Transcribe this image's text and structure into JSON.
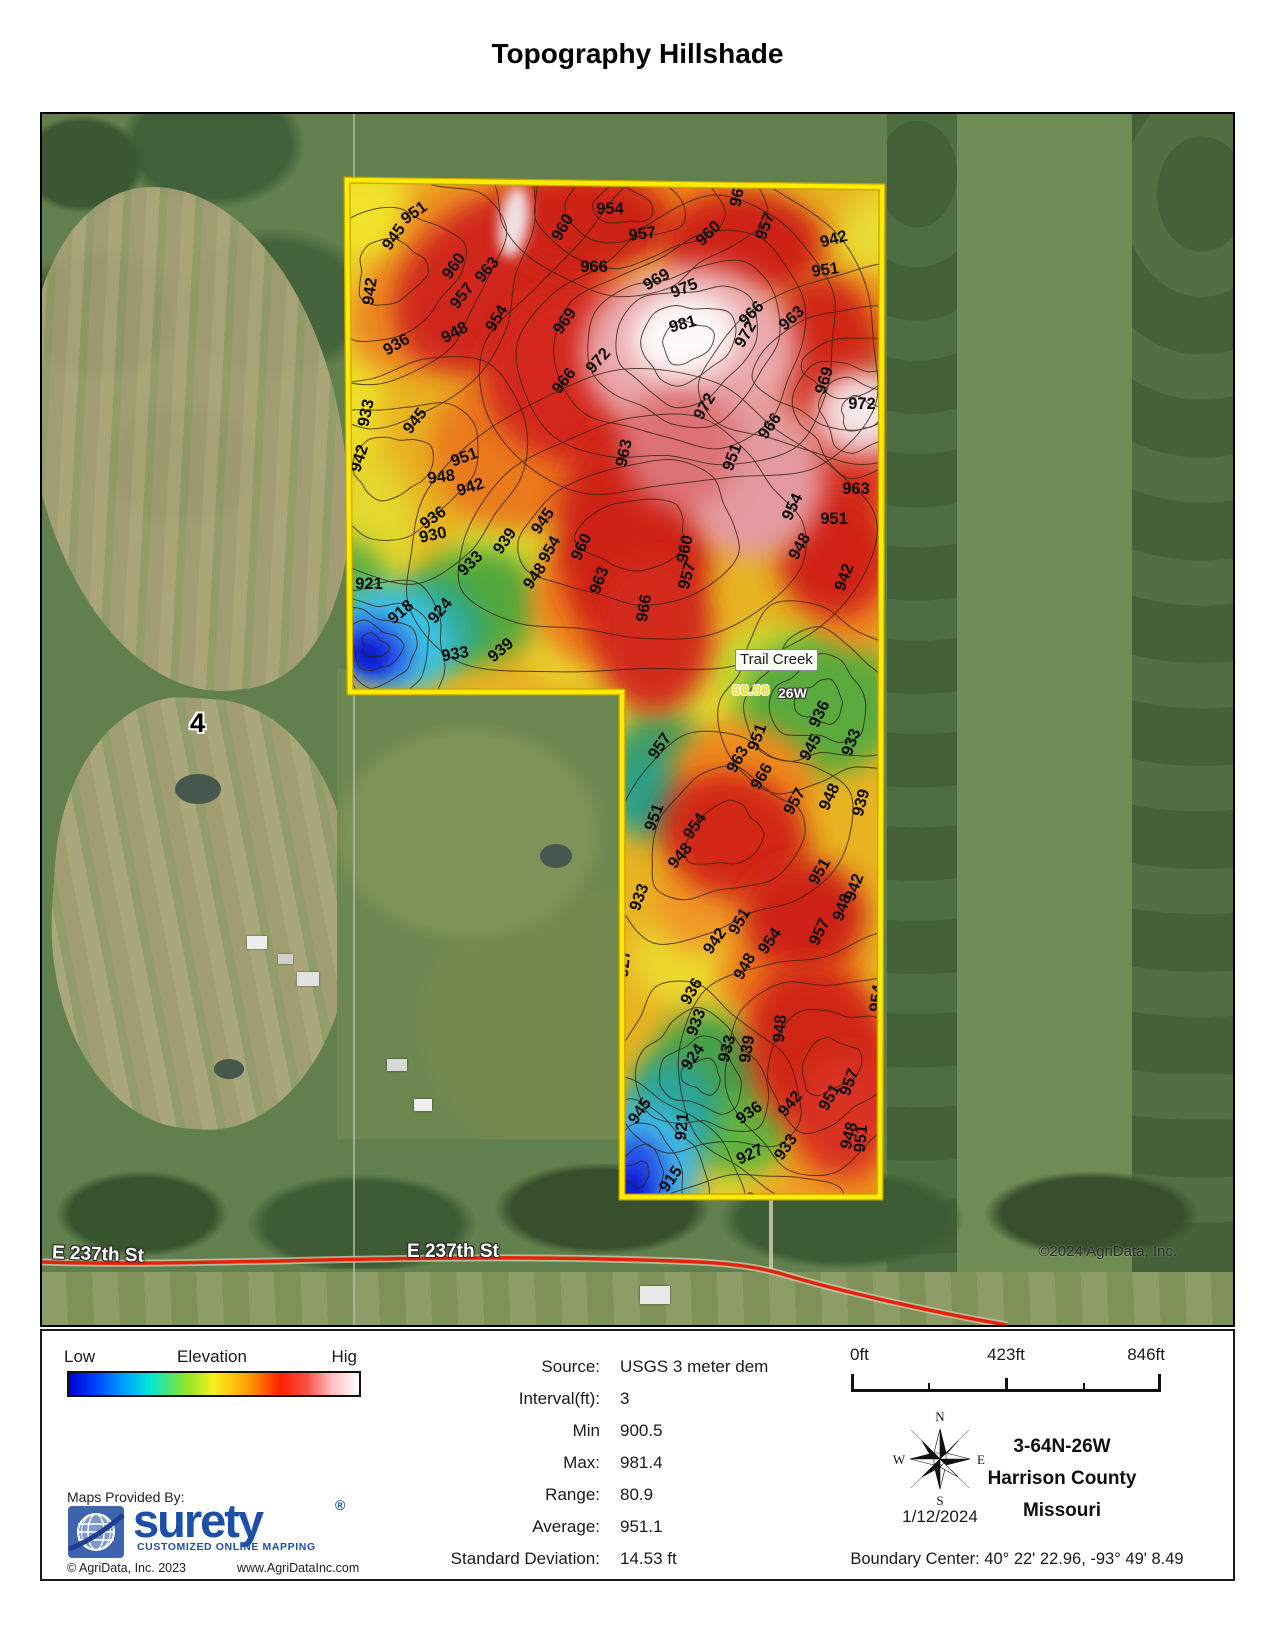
{
  "title": "Topography Hillshade",
  "map": {
    "labels": {
      "trail_creek": "Trail Creek",
      "road_number": "60.00",
      "road_suffix": "26W",
      "street_left": "E 237th St",
      "street_center": "E 237th St",
      "section_number": "4",
      "copyright": "©2024 AgriData, Inc."
    },
    "contour_labels": [
      {
        "t": "951",
        "x": 375,
        "y": 103,
        "r": -35
      },
      {
        "t": "945",
        "x": 356,
        "y": 126,
        "r": -55
      },
      {
        "t": "954",
        "x": 568,
        "y": 100,
        "r": 0
      },
      {
        "t": "957",
        "x": 601,
        "y": 125,
        "r": -8
      },
      {
        "t": "960",
        "x": 525,
        "y": 116,
        "r": -60
      },
      {
        "t": "963",
        "x": 701,
        "y": 80,
        "r": -78
      },
      {
        "t": "957",
        "x": 728,
        "y": 114,
        "r": -70
      },
      {
        "t": "960",
        "x": 670,
        "y": 123,
        "r": -45
      },
      {
        "t": "942",
        "x": 793,
        "y": 130,
        "r": -15
      },
      {
        "t": "951",
        "x": 784,
        "y": 161,
        "r": -8
      },
      {
        "t": "960",
        "x": 416,
        "y": 155,
        "r": -55
      },
      {
        "t": "963",
        "x": 449,
        "y": 159,
        "r": -50
      },
      {
        "t": "966",
        "x": 552,
        "y": 158,
        "r": 0
      },
      {
        "t": "957",
        "x": 424,
        "y": 185,
        "r": -52
      },
      {
        "t": "954",
        "x": 459,
        "y": 207,
        "r": -58
      },
      {
        "t": "969",
        "x": 617,
        "y": 170,
        "r": -30
      },
      {
        "t": "975",
        "x": 644,
        "y": 179,
        "r": -22
      },
      {
        "t": "966",
        "x": 713,
        "y": 203,
        "r": -45
      },
      {
        "t": "963",
        "x": 753,
        "y": 208,
        "r": -42
      },
      {
        "t": "972",
        "x": 708,
        "y": 223,
        "r": -60
      },
      {
        "t": "942",
        "x": 333,
        "y": 178,
        "r": -82
      },
      {
        "t": "936",
        "x": 357,
        "y": 235,
        "r": -30
      },
      {
        "t": "948",
        "x": 415,
        "y": 223,
        "r": -28
      },
      {
        "t": "981",
        "x": 642,
        "y": 215,
        "r": -15
      },
      {
        "t": "969",
        "x": 527,
        "y": 210,
        "r": -55
      },
      {
        "t": "972",
        "x": 560,
        "y": 250,
        "r": -48
      },
      {
        "t": "966",
        "x": 526,
        "y": 270,
        "r": -52
      },
      {
        "t": "969",
        "x": 787,
        "y": 268,
        "r": -72
      },
      {
        "t": "972",
        "x": 820,
        "y": 295,
        "r": 0
      },
      {
        "t": "933",
        "x": 329,
        "y": 300,
        "r": -78
      },
      {
        "t": "945",
        "x": 377,
        "y": 310,
        "r": -52
      },
      {
        "t": "942",
        "x": 322,
        "y": 346,
        "r": -72
      },
      {
        "t": "951",
        "x": 424,
        "y": 348,
        "r": -20
      },
      {
        "t": "948",
        "x": 400,
        "y": 368,
        "r": -8
      },
      {
        "t": "942",
        "x": 430,
        "y": 378,
        "r": -18
      },
      {
        "t": "963",
        "x": 587,
        "y": 340,
        "r": -78
      },
      {
        "t": "972",
        "x": 667,
        "y": 295,
        "r": -60
      },
      {
        "t": "966",
        "x": 732,
        "y": 315,
        "r": -55
      },
      {
        "t": "951",
        "x": 695,
        "y": 345,
        "r": -70
      },
      {
        "t": "963",
        "x": 814,
        "y": 380,
        "r": 0
      },
      {
        "t": "954",
        "x": 755,
        "y": 395,
        "r": -65
      },
      {
        "t": "951",
        "x": 792,
        "y": 410,
        "r": 0
      },
      {
        "t": "948",
        "x": 762,
        "y": 435,
        "r": -60
      },
      {
        "t": "936",
        "x": 394,
        "y": 408,
        "r": -35
      },
      {
        "t": "930",
        "x": 392,
        "y": 426,
        "r": -12
      },
      {
        "t": "939",
        "x": 467,
        "y": 430,
        "r": -55
      },
      {
        "t": "933",
        "x": 432,
        "y": 453,
        "r": -45
      },
      {
        "t": "945",
        "x": 505,
        "y": 410,
        "r": -55
      },
      {
        "t": "954",
        "x": 512,
        "y": 438,
        "r": -60
      },
      {
        "t": "960",
        "x": 544,
        "y": 435,
        "r": -65
      },
      {
        "t": "948",
        "x": 497,
        "y": 465,
        "r": -55
      },
      {
        "t": "963",
        "x": 562,
        "y": 468,
        "r": -70
      },
      {
        "t": "960",
        "x": 648,
        "y": 436,
        "r": -78
      },
      {
        "t": "957",
        "x": 650,
        "y": 463,
        "r": -75
      },
      {
        "t": "966",
        "x": 607,
        "y": 495,
        "r": -80
      },
      {
        "t": "942",
        "x": 807,
        "y": 465,
        "r": -70
      },
      {
        "t": "921",
        "x": 327,
        "y": 475,
        "r": 0
      },
      {
        "t": "918",
        "x": 362,
        "y": 502,
        "r": -40
      },
      {
        "t": "924",
        "x": 402,
        "y": 500,
        "r": -50
      },
      {
        "t": "933",
        "x": 414,
        "y": 545,
        "r": -10
      },
      {
        "t": "939",
        "x": 462,
        "y": 540,
        "r": -40
      },
      {
        "t": "936",
        "x": 782,
        "y": 602,
        "r": -65
      },
      {
        "t": "933",
        "x": 814,
        "y": 630,
        "r": -70
      },
      {
        "t": "945",
        "x": 773,
        "y": 636,
        "r": -60
      },
      {
        "t": "951",
        "x": 720,
        "y": 625,
        "r": -70
      },
      {
        "t": "957",
        "x": 622,
        "y": 635,
        "r": -55
      },
      {
        "t": "963",
        "x": 700,
        "y": 648,
        "r": -60
      },
      {
        "t": "966",
        "x": 724,
        "y": 665,
        "r": -60
      },
      {
        "t": "939",
        "x": 824,
        "y": 690,
        "r": -75
      },
      {
        "t": "948",
        "x": 792,
        "y": 685,
        "r": -65
      },
      {
        "t": "957",
        "x": 757,
        "y": 690,
        "r": -60
      },
      {
        "t": "951",
        "x": 617,
        "y": 705,
        "r": -70
      },
      {
        "t": "954",
        "x": 657,
        "y": 715,
        "r": -55
      },
      {
        "t": "948",
        "x": 642,
        "y": 745,
        "r": -50
      },
      {
        "t": "951",
        "x": 782,
        "y": 760,
        "r": -60
      },
      {
        "t": "942",
        "x": 817,
        "y": 775,
        "r": -70
      },
      {
        "t": "948",
        "x": 805,
        "y": 795,
        "r": -70
      },
      {
        "t": "933",
        "x": 602,
        "y": 785,
        "r": -70
      },
      {
        "t": "927",
        "x": 587,
        "y": 850,
        "r": -85
      },
      {
        "t": "942",
        "x": 677,
        "y": 830,
        "r": -55
      },
      {
        "t": "951",
        "x": 702,
        "y": 810,
        "r": -60
      },
      {
        "t": "954",
        "x": 732,
        "y": 830,
        "r": -55
      },
      {
        "t": "948",
        "x": 707,
        "y": 855,
        "r": -60
      },
      {
        "t": "957",
        "x": 782,
        "y": 820,
        "r": -65
      },
      {
        "t": "954",
        "x": 840,
        "y": 885,
        "r": -82
      },
      {
        "t": "936",
        "x": 654,
        "y": 880,
        "r": -60
      },
      {
        "t": "933",
        "x": 659,
        "y": 910,
        "r": -70
      },
      {
        "t": "924",
        "x": 655,
        "y": 946,
        "r": -55
      },
      {
        "t": "933",
        "x": 690,
        "y": 936,
        "r": -75
      },
      {
        "t": "939",
        "x": 710,
        "y": 936,
        "r": -80
      },
      {
        "t": "948",
        "x": 743,
        "y": 915,
        "r": -85
      },
      {
        "t": "951",
        "x": 792,
        "y": 986,
        "r": -60
      },
      {
        "t": "942",
        "x": 752,
        "y": 993,
        "r": -50
      },
      {
        "t": "948",
        "x": 812,
        "y": 1023,
        "r": -75
      },
      {
        "t": "936",
        "x": 710,
        "y": 1003,
        "r": -35
      },
      {
        "t": "933",
        "x": 748,
        "y": 1036,
        "r": -55
      },
      {
        "t": "921",
        "x": 645,
        "y": 1013,
        "r": -85
      },
      {
        "t": "927",
        "x": 710,
        "y": 1045,
        "r": -25
      },
      {
        "t": "915",
        "x": 633,
        "y": 1068,
        "r": -55
      },
      {
        "t": "918",
        "x": 608,
        "y": 1098,
        "r": -70
      },
      {
        "t": "930",
        "x": 713,
        "y": 1093,
        "r": -75
      },
      {
        "t": "942",
        "x": 768,
        "y": 1098,
        "r": -35
      },
      {
        "t": "951",
        "x": 824,
        "y": 1025,
        "r": -85
      },
      {
        "t": "945",
        "x": 602,
        "y": 1000,
        "r": -55
      },
      {
        "t": "957",
        "x": 812,
        "y": 970,
        "r": -70
      }
    ]
  },
  "legend": {
    "low": "Low",
    "title": "Elevation",
    "high": "Hig"
  },
  "stats": {
    "rows": [
      {
        "label": "Source:",
        "value": "USGS 3 meter dem"
      },
      {
        "label": "Interval(ft):",
        "value": "3"
      },
      {
        "label": "Min",
        "value": "900.5"
      },
      {
        "label": "Max:",
        "value": "981.4"
      },
      {
        "label": "Range:",
        "value": "80.9"
      },
      {
        "label": "Average:",
        "value": "951.1"
      },
      {
        "label": "Standard Deviation:",
        "value": "14.53 ft"
      }
    ]
  },
  "scalebar": {
    "start": "0ft",
    "mid": "423ft",
    "end": "846ft"
  },
  "compass": {
    "n": "N",
    "e": "E",
    "s": "S",
    "w": "W",
    "date": "1/12/2024"
  },
  "location": {
    "trs": "3-64N-26W",
    "county": "Harrison County",
    "state": "Missouri",
    "boundary_center": "Boundary Center: 40° 22' 22.96,  -93° 49' 8.49"
  },
  "provider": {
    "heading": "Maps Provided By:",
    "brand": "surety",
    "reg": "®",
    "tagline": "CUSTOMIZED ONLINE MAPPING",
    "copyright": "© AgriData, Inc. 2023",
    "website": "www.AgriDataInc.com"
  },
  "colors": {
    "boundary": "#ffec00",
    "road": "#e52207",
    "elevation_low": "#0000cf",
    "elevation_high": "#ffffff"
  }
}
